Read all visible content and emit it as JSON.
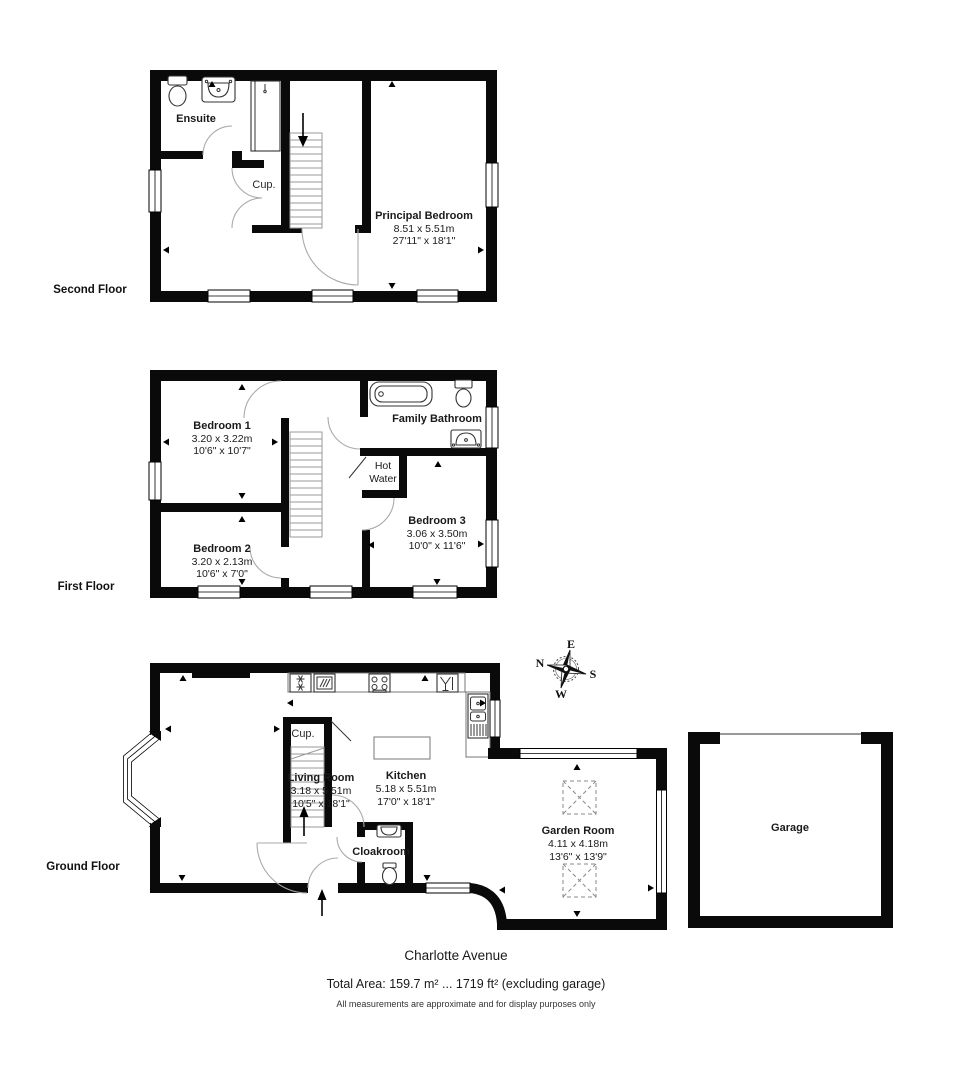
{
  "floors": {
    "second": {
      "label": "Second Floor",
      "rooms": {
        "ensuite": {
          "name": "Ensuite"
        },
        "cupboard": {
          "name": "Cup."
        },
        "principal_bedroom": {
          "name": "Principal Bedroom",
          "metric": "8.51 x 5.51m",
          "imperial": "27'11\" x 18'1\""
        }
      }
    },
    "first": {
      "label": "First Floor",
      "rooms": {
        "bedroom1": {
          "name": "Bedroom 1",
          "metric": "3.20 x 3.22m",
          "imperial": "10'6\" x 10'7\""
        },
        "bedroom2": {
          "name": "Bedroom 2",
          "metric": "3.20 x 2.13m",
          "imperial": "10'6\" x 7'0\""
        },
        "family_bathroom": {
          "name": "Family Bathroom"
        },
        "hot_water": {
          "line1": "Hot",
          "line2": "Water"
        },
        "bedroom3": {
          "name": "Bedroom 3",
          "metric": "3.06 x 3.50m",
          "imperial": "10'0\" x 11'6\""
        }
      }
    },
    "ground": {
      "label": "Ground Floor",
      "rooms": {
        "living_room": {
          "name": "Living Room",
          "metric": "3.18 x 5.51m",
          "imperial": "10'5\" x 18'1\""
        },
        "kitchen": {
          "name": "Kitchen",
          "metric": "5.18 x 5.51m",
          "imperial": "17'0\" x 18'1\""
        },
        "cupboard": {
          "name": "Cup."
        },
        "cloakroom": {
          "name": "Cloakroom"
        },
        "garden_room": {
          "name": "Garden Room",
          "metric": "4.11 x 4.18m",
          "imperial": "13'6\" x 13'9\""
        },
        "garage": {
          "name": "Garage"
        }
      }
    }
  },
  "compass": {
    "north": "N",
    "east": "E",
    "south": "S",
    "west": "W"
  },
  "footer": {
    "street": "Charlotte Avenue",
    "total_area": "Total Area: 159.7 m² ... 1719 ft² (excluding garage)",
    "disclaimer": "All measurements are approximate and for display purposes only"
  },
  "colors": {
    "wall": "#0a0a0a",
    "door_arc": "#aaaaaa",
    "background": "#ffffff"
  }
}
